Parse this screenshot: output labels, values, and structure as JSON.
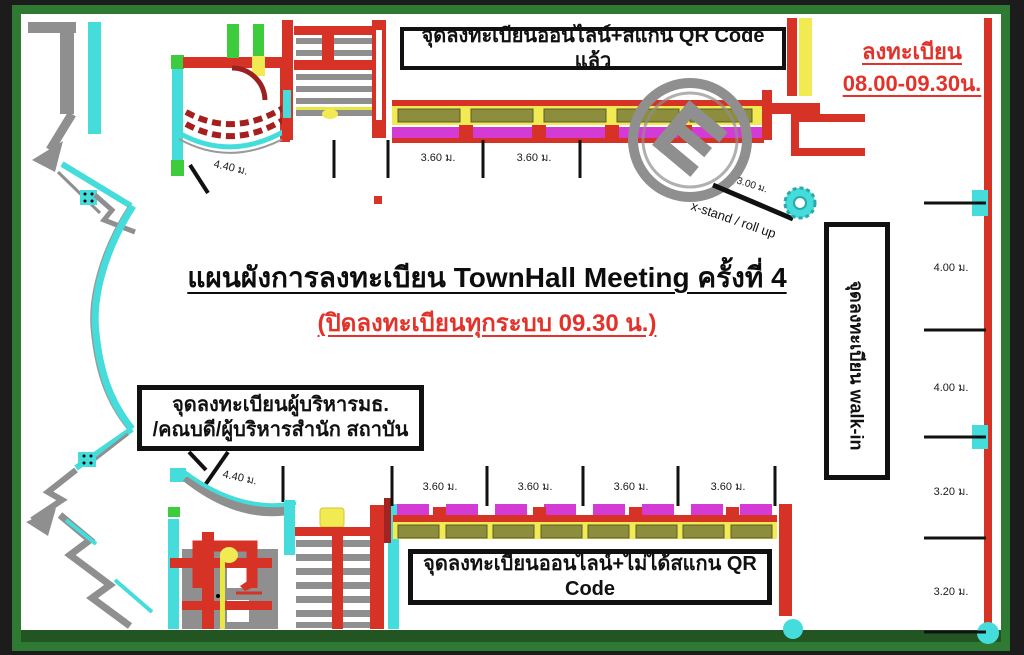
{
  "title": {
    "main": "แผนผังการลงทะเบียน TownHall Meeting ครั้งที่ 4",
    "sub": "(ปิดลงทะเบียนทุกระบบ 09.30 น.)"
  },
  "register_time": {
    "line1": "ลงทะเบียน",
    "line2": "08.00-09.30น."
  },
  "callouts": {
    "online_scanned": "จุดลงทะเบียนออนไลน์+สแกน QR Code แล้ว",
    "online_not_scanned": "จุดลงทะเบียนออนไลน์+ไม่ได้สแกน QR Code",
    "executives_line1": "จุดลงทะเบียนผู้บริหารมธ.",
    "executives_line2": "/คณบดี/ผู้บริหารสำนัก สถาบัน",
    "walkin": "จุดลงทะเบียน walk-in",
    "xstand": "x-stand / roll up"
  },
  "dims": {
    "top_room": "4.40 ม.",
    "bottom_room": "4.40 ม.",
    "xstand": "3.00 ม.",
    "top_row": [
      "3.60 ม.",
      "3.60 ม."
    ],
    "bottom_row": [
      "3.60 ม.",
      "3.60 ม.",
      "3.60 ม.",
      "3.60 ม."
    ],
    "right_col": [
      "4.00 ม.",
      "4.00 ม.",
      "3.20 ม.",
      "3.20 ม."
    ]
  },
  "colors": {
    "wall_red": "#d63226",
    "dark_red": "#a02020",
    "accent_cyan": "#45dcdc",
    "table_magenta": "#d43bd4",
    "band_yellow": "#f2ea52",
    "table_olive": "#8d8d3e",
    "accent_green": "#3ccc3c",
    "frame_green": "#2e7a33",
    "note_red": "#e2322a",
    "structure_gray": "#8f8f8f"
  }
}
